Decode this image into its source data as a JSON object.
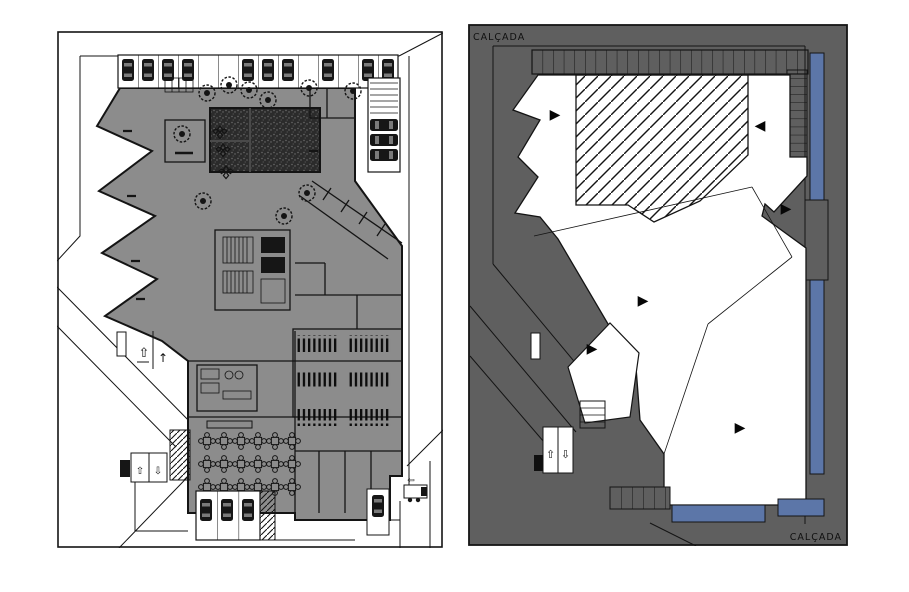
{
  "canvas": {
    "width": 909,
    "height": 592,
    "background": "#ffffff"
  },
  "floor_plan_panel": {
    "colors": {
      "floor_fill": "#8c8c8c",
      "stage_dark": "#2b2b2b",
      "line": "#141414",
      "paper": "#ffffff"
    },
    "ramp_arrows": {
      "upper_up": "⇧",
      "upper_up_thin": "↑",
      "lower_up": "⇧",
      "lower_down": "⇩"
    },
    "truck_arrow": "⇦"
  },
  "site_plan_panel": {
    "labels": {
      "sidewalk_top": "CALÇADA",
      "sidewalk_bottom": "CALÇADA"
    },
    "colors": {
      "ground_fill": "#5f5f5f",
      "roof_fill": "#ffffff",
      "accent_blue": "#5c76a8",
      "line": "#141414"
    },
    "ramp_arrows": {
      "up": "⇧",
      "down": "⇩"
    },
    "glyphs": {
      "marker_right": "▶",
      "marker_left": "◀"
    }
  }
}
